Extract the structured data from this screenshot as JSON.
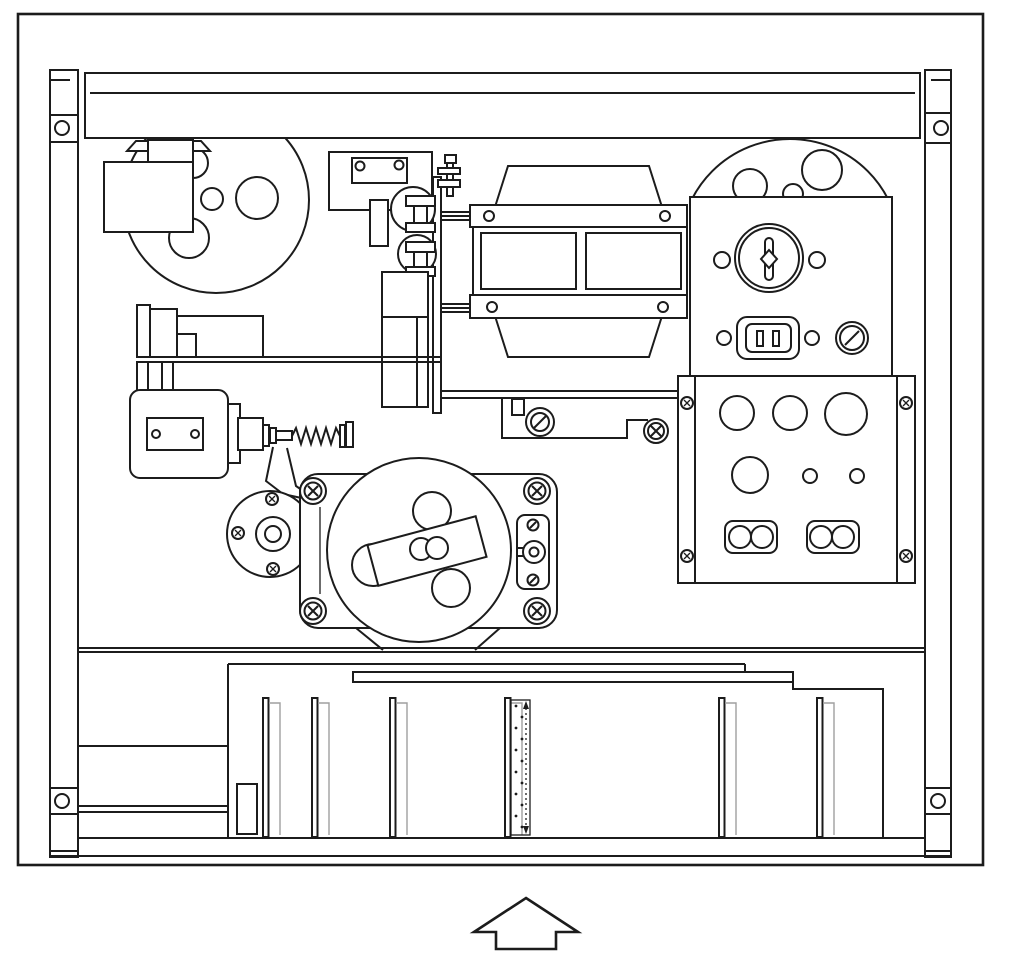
{
  "meta": {
    "figure_type": "technical-line-drawing",
    "view": "chassis-top-view"
  },
  "colors": {
    "ink": "#1c1c1c",
    "paper": "#ffffff",
    "shadow": "#9f9f9f"
  },
  "canvas": {
    "width": 1024,
    "height": 968
  },
  "components": [
    "outer-frame",
    "left-rail",
    "right-rail",
    "front-crossbar",
    "supply-reel",
    "head-cover",
    "pinch-roller-bracket",
    "roller-clamps",
    "mounting-plate",
    "coupling-bolt",
    "drive-block",
    "cross-member",
    "transformer",
    "capstan-motor-dome",
    "fuse-panel",
    "power-inlet",
    "terminal-panel",
    "solenoid",
    "return-spring",
    "actuator-lever",
    "idler-pulley",
    "flywheel-motor",
    "motor-switch-bracket",
    "indicator-lamp",
    "chassis-divider",
    "card-cage",
    "guide-slat",
    "circuit-cards",
    "insert-direction-arrow"
  ],
  "card_cage": {
    "card_top": 698,
    "card_bottom": 837,
    "cards": [
      {
        "x": 263,
        "stippled": false
      },
      {
        "x": 312,
        "stippled": false
      },
      {
        "x": 390,
        "stippled": false
      },
      {
        "x": 505,
        "stippled": true
      },
      {
        "x": 719,
        "stippled": false
      },
      {
        "x": 817,
        "stippled": false
      }
    ]
  },
  "arrow": {
    "direction": "up",
    "symbol": "⇧"
  }
}
